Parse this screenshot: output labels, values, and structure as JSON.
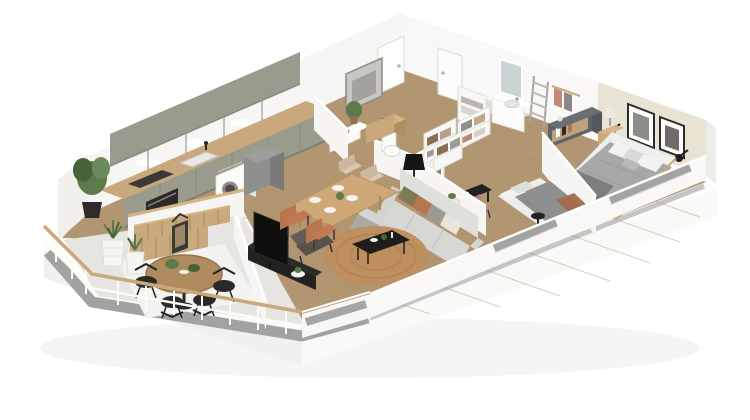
{
  "scene": {
    "title": "3D isometric apartment floor plan render",
    "style": "dollhouse cutaway perspective, white walls, light oak floor",
    "background": "#ffffff"
  },
  "palette": {
    "background": "#ffffff",
    "wall": "#f6f5f3",
    "wall_shade": "#efeeec",
    "wall_top": "#ffffff",
    "accent_wall_beige": "#e9e3d3",
    "floor_wood": "#b29672",
    "plank_line": "#a2886a",
    "concrete_grey": "#a2a2a0",
    "balcony_floor": "#e6e5e2",
    "balcony_mat": "#f3f2f0",
    "cabinet_sage": "#9b9b8d",
    "counter_wood": "#c8a87c",
    "wood_mid": "#c9a87a",
    "wood_dark": "#a9875c",
    "black": "#232220",
    "charcoal": "#3a3836",
    "appliance_steel": "#8e8c88",
    "sofa_grey": "#d7d7d4",
    "rug_jute": "#bf8e5d",
    "bedding_grey": "#a7a8a8",
    "bedding_dark": "#7d7e7e",
    "linen_white": "#efefed",
    "terracotta": "#bf7a55",
    "rust": "#b4764f",
    "olive": "#7d7a55",
    "blush": "#c08a84",
    "plant_green": "#5d7a49",
    "plant_dark": "#47633a",
    "glass_grey": "#a5a5a3",
    "tile_grey": "#dcdbd8"
  },
  "rooms": [
    {
      "name": "balcony-terrace",
      "furniture": [
        "round-wood-dining-table",
        "four-black-wire-chairs",
        "slatted-wood-planter-bench",
        "wood-lantern",
        "white-ribbed-planters-with-succulents",
        "white-railing-with-wood-handrail"
      ]
    },
    {
      "name": "kitchen",
      "furniture": [
        "sage-green-lower-cabinet-run",
        "wood-countertop",
        "built-in-oven",
        "cooktop",
        "sink-with-black-faucet",
        "washing-machine",
        "tall-grey-cabinet",
        "sage-upper-cabinets-with-under-lighting",
        "potted-plant",
        "white-peninsula-with-wood-slats"
      ]
    },
    {
      "name": "dining-area",
      "furniture": [
        "rectangular-wood-table-set-for-four",
        "two-terracotta-chairs",
        "two-light-wood-chairs",
        "wood-sideboard",
        "plant-on-stand"
      ]
    },
    {
      "name": "living-room",
      "furniture": [
        "light-grey-sofa-with-olive-rust-grey-cushions",
        "round-jute-rug",
        "black-coffee-table-with-decor",
        "dark-grey-armchair",
        "black-floor-lamp",
        "tv-on-long-black-media-console",
        "white-side-table-with-plant"
      ]
    },
    {
      "name": "entrance-hall",
      "furniture": [
        "white-front-door",
        "second-white-door",
        "abstract-grey-wall-art",
        "wood-console",
        "white-bench"
      ]
    },
    {
      "name": "wc",
      "furniture": [
        "toilet"
      ]
    },
    {
      "name": "dressing",
      "furniture": [
        "white-open-wardrobes-with-folded-clothes"
      ]
    },
    {
      "name": "bathroom",
      "furniture": [
        "white-vanity-with-basin",
        "wall-mirror",
        "grey-towel-ladder",
        "white-shelf-with-towels"
      ]
    },
    {
      "name": "bedroom-2",
      "furniture": [
        "double-bed-grey-and-white-bedding",
        "black-desk",
        "blush-desk-chair",
        "black-round-side-table",
        "white-wardrobe-with-clothes"
      ]
    },
    {
      "name": "master-bedroom",
      "furniture": [
        "double-bed-grey-bedding-wood-frame",
        "two-framed-black-and-white-artworks",
        "two-black-wall-sconces",
        "wood-nightstands",
        "table-lamp",
        "grey-dresser-with-books",
        "rust-foot-bench",
        "clothes-rack"
      ]
    }
  ]
}
